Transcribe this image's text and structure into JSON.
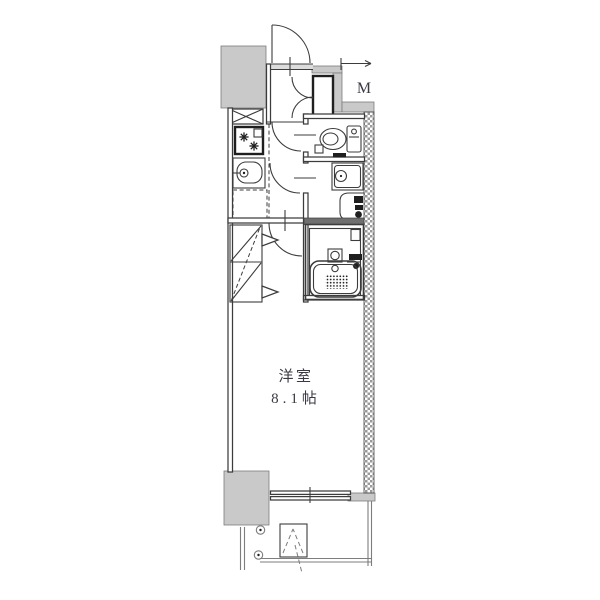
{
  "labels": {
    "room": "洋室",
    "size": "8.1帖",
    "meter": "M"
  },
  "colors": {
    "line": "#3c3c3c",
    "dark": "#1f1f1f",
    "soft": "#7d7d7d",
    "wall_fill": "#c9c9c9",
    "hatch": "#9a9a9a",
    "divider_fill": "#6f6f6f",
    "opening_fill": "#dcdcdc",
    "text": "#3a3a44",
    "bg": "#ffffff"
  },
  "fixtures": [
    "entrance-door",
    "shoe-cabinet",
    "meter-box",
    "pipe-space",
    "gas-stove",
    "kitchen-sink",
    "kitchen-counter",
    "closet-folding-doors",
    "toilet",
    "washbasin",
    "washing-machine-pan",
    "bathtub",
    "bath-drain",
    "sliding-window",
    "balcony",
    "evacuation-hatch"
  ]
}
